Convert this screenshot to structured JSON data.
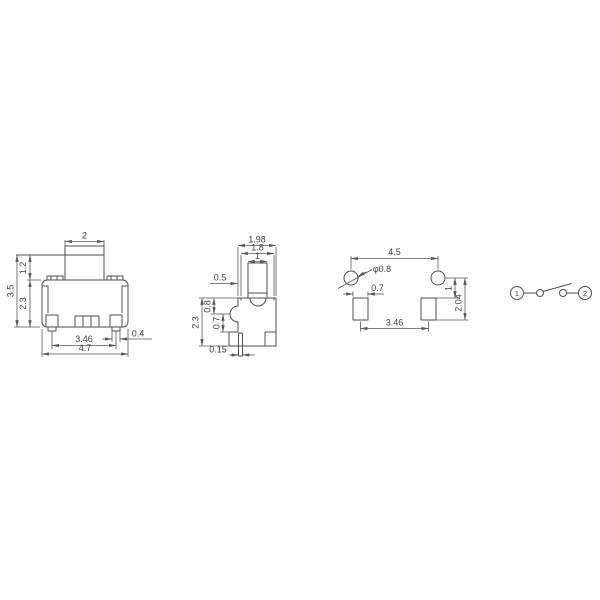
{
  "colors": {
    "line": "#4f4f4f",
    "dimension_line": "#585858",
    "label_text": "#3f3f3f",
    "background": "#ffffff"
  },
  "drawing": {
    "front_view": {
      "button_width": "2",
      "overall_height": "3.5",
      "button_height": "1.2",
      "body_height": "2.3",
      "terminal_pitch": "3.46",
      "overall_width": "4.7",
      "terminal_width": "0.4"
    },
    "side_view": {
      "overall_depth": "1.98",
      "body_depth": "1.8",
      "button_depth": "1",
      "button_offset": "0.5",
      "boss_height": "0.8",
      "boss_to_base": "0.7",
      "body_height": "2.3",
      "lead_thickness": "0.15"
    },
    "land_pattern": {
      "hole_pitch": "4.5",
      "hole_diameter": "φ0.8",
      "pad_width": "0.7",
      "hole_to_pad_top": "1",
      "pad_pitch": "3.46",
      "hole_to_pad_bottom": "2.04"
    },
    "schematic": {
      "terminal_1": "1",
      "terminal_2": "2"
    }
  }
}
